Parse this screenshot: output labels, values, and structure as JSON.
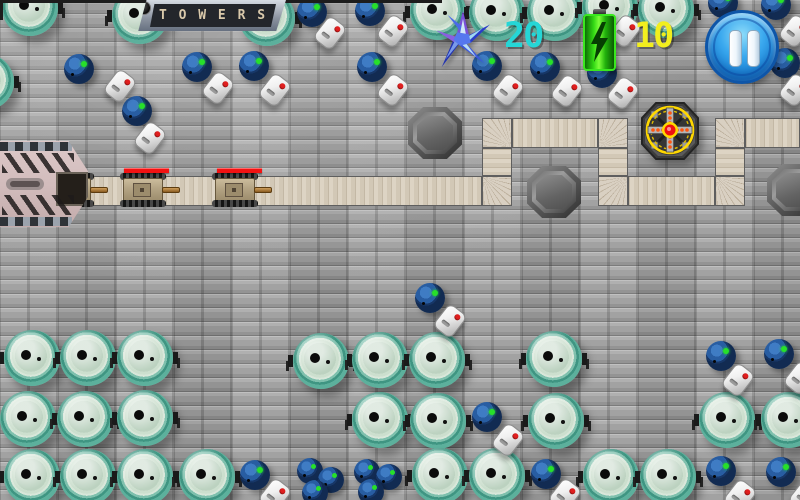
{
  "hud": {
    "sign_label": "T O W E R S",
    "stars_count": "20",
    "stars_color": "#25d6d6",
    "energy_count": "10",
    "energy_color": "#f2ee1e",
    "icons": [
      "shuriken-icon",
      "battery-icon",
      "pause-icon"
    ]
  },
  "scene": {
    "path": {
      "straights": [
        {
          "x": 75,
          "y": 176,
          "w": 407,
          "h": 30,
          "dir": "h"
        },
        {
          "x": 512,
          "y": 118,
          "w": 86,
          "h": 30,
          "dir": "h"
        },
        {
          "x": 628,
          "y": 176,
          "w": 87,
          "h": 30,
          "dir": "h"
        },
        {
          "x": 745,
          "y": 118,
          "w": 55,
          "h": 30,
          "dir": "h"
        },
        {
          "x": 482,
          "y": 148,
          "w": 30,
          "h": 28,
          "dir": "v"
        },
        {
          "x": 598,
          "y": 148,
          "w": 30,
          "h": 28,
          "dir": "v"
        },
        {
          "x": 715,
          "y": 148,
          "w": 30,
          "h": 28,
          "dir": "v"
        }
      ],
      "corners": [
        {
          "x": 482,
          "y": 176,
          "fx": 0,
          "fy": 0
        },
        {
          "x": 482,
          "y": 118,
          "fx": 1,
          "fy": 1
        },
        {
          "x": 598,
          "y": 118,
          "fx": 0,
          "fy": 1
        },
        {
          "x": 598,
          "y": 176,
          "fx": 1,
          "fy": 0
        },
        {
          "x": 715,
          "y": 176,
          "fx": 0,
          "fy": 0
        },
        {
          "x": 715,
          "y": 118,
          "fx": 1,
          "fy": 1
        }
      ]
    },
    "tower": {
      "type": "blade-tower",
      "x": 670,
      "y": 131
    },
    "tower_spots": [
      {
        "x": 435,
        "y": 133
      },
      {
        "x": 554,
        "y": 192
      },
      {
        "x": 794,
        "y": 190
      }
    ],
    "enemies": [
      {
        "type": "tank",
        "x": 74,
        "y": 190,
        "hp_x": 57,
        "hp_w": 23
      },
      {
        "type": "tank",
        "x": 146,
        "y": 190,
        "hp_x": 124,
        "hp_w": 45
      },
      {
        "type": "tank",
        "x": 238,
        "y": 190,
        "hp_x": 217,
        "hp_w": 45
      }
    ],
    "props": [
      {
        "type": "vat",
        "x": 30,
        "y": 8
      },
      {
        "type": "vat",
        "x": 140,
        "y": 16
      },
      {
        "type": "vat",
        "x": 267,
        "y": 18
      },
      {
        "type": "vat",
        "x": 438,
        "y": 12
      },
      {
        "type": "vat",
        "x": 497,
        "y": 13
      },
      {
        "type": "vat",
        "x": 555,
        "y": 13
      },
      {
        "type": "vat",
        "x": 610,
        "y": 8
      },
      {
        "type": "vat",
        "x": 666,
        "y": 10
      },
      {
        "type": "vat",
        "x": -14,
        "y": 82
      },
      {
        "type": "vat",
        "x": 32,
        "y": 358
      },
      {
        "type": "vat",
        "x": 88,
        "y": 358
      },
      {
        "type": "vat",
        "x": 145,
        "y": 358
      },
      {
        "type": "vat",
        "x": 321,
        "y": 361
      },
      {
        "type": "vat",
        "x": 380,
        "y": 360
      },
      {
        "type": "vat",
        "x": 437,
        "y": 360
      },
      {
        "type": "vat",
        "x": 554,
        "y": 359
      },
      {
        "type": "vat",
        "x": 28,
        "y": 419
      },
      {
        "type": "vat",
        "x": 85,
        "y": 419
      },
      {
        "type": "vat",
        "x": 145,
        "y": 418
      },
      {
        "type": "vat",
        "x": 380,
        "y": 420
      },
      {
        "type": "vat",
        "x": 438,
        "y": 421
      },
      {
        "type": "vat",
        "x": 556,
        "y": 421
      },
      {
        "type": "vat",
        "x": 727,
        "y": 420
      },
      {
        "type": "vat",
        "x": 789,
        "y": 420
      },
      {
        "type": "vat",
        "x": 32,
        "y": 477
      },
      {
        "type": "vat",
        "x": 88,
        "y": 477
      },
      {
        "type": "vat",
        "x": 145,
        "y": 477
      },
      {
        "type": "vat",
        "x": 207,
        "y": 477
      },
      {
        "type": "vat",
        "x": 440,
        "y": 476
      },
      {
        "type": "vat",
        "x": 497,
        "y": 476
      },
      {
        "type": "vat",
        "x": 611,
        "y": 477
      },
      {
        "type": "vat",
        "x": 668,
        "y": 477
      },
      {
        "type": "barrel",
        "x": 79,
        "y": 69
      },
      {
        "type": "barrel",
        "x": 137,
        "y": 111
      },
      {
        "type": "barrel",
        "x": 197,
        "y": 67
      },
      {
        "type": "barrel",
        "x": 254,
        "y": 66
      },
      {
        "type": "barrel",
        "x": 312,
        "y": 12
      },
      {
        "type": "barrel",
        "x": 370,
        "y": 11
      },
      {
        "type": "barrel",
        "x": 372,
        "y": 67
      },
      {
        "type": "barrel",
        "x": 487,
        "y": 66
      },
      {
        "type": "barrel",
        "x": 545,
        "y": 67
      },
      {
        "type": "barrel",
        "x": 602,
        "y": 73
      },
      {
        "type": "barrel",
        "x": 723,
        "y": 3
      },
      {
        "type": "barrel",
        "x": 776,
        "y": 5
      },
      {
        "type": "barrel",
        "x": 785,
        "y": 63
      },
      {
        "type": "barrel",
        "x": 430,
        "y": 298
      },
      {
        "type": "barrel",
        "x": 487,
        "y": 417
      },
      {
        "type": "barrel",
        "x": 255,
        "y": 475
      },
      {
        "type": "barrel",
        "x": 546,
        "y": 474
      },
      {
        "type": "barrel",
        "x": 721,
        "y": 471
      },
      {
        "type": "barrel",
        "x": 781,
        "y": 472
      },
      {
        "type": "barrel",
        "x": 721,
        "y": 356
      },
      {
        "type": "barrel",
        "x": 779,
        "y": 354
      },
      {
        "type": "barrel-small",
        "x": 310,
        "y": 471
      },
      {
        "type": "barrel-small",
        "x": 331,
        "y": 480
      },
      {
        "type": "barrel-small",
        "x": 315,
        "y": 493
      },
      {
        "type": "barrel-small",
        "x": 367,
        "y": 472
      },
      {
        "type": "barrel-small",
        "x": 389,
        "y": 477
      },
      {
        "type": "barrel-small",
        "x": 371,
        "y": 492
      },
      {
        "type": "canister",
        "x": 120,
        "y": 86
      },
      {
        "type": "canister",
        "x": 150,
        "y": 138
      },
      {
        "type": "canister",
        "x": 218,
        "y": 88
      },
      {
        "type": "canister",
        "x": 275,
        "y": 90
      },
      {
        "type": "canister",
        "x": 330,
        "y": 33
      },
      {
        "type": "canister",
        "x": 393,
        "y": 31
      },
      {
        "type": "canister",
        "x": 393,
        "y": 90
      },
      {
        "type": "canister",
        "x": 508,
        "y": 90
      },
      {
        "type": "canister",
        "x": 567,
        "y": 91
      },
      {
        "type": "canister",
        "x": 623,
        "y": 93
      },
      {
        "type": "canister",
        "x": 625,
        "y": 31
      },
      {
        "type": "canister",
        "x": 738,
        "y": 380
      },
      {
        "type": "canister",
        "x": 800,
        "y": 378
      },
      {
        "type": "canister",
        "x": 795,
        "y": 31
      },
      {
        "type": "canister",
        "x": 795,
        "y": 90
      },
      {
        "type": "canister",
        "x": 450,
        "y": 321
      },
      {
        "type": "canister",
        "x": 508,
        "y": 440
      },
      {
        "type": "canister",
        "x": 275,
        "y": 495
      },
      {
        "type": "canister",
        "x": 565,
        "y": 495
      },
      {
        "type": "canister",
        "x": 740,
        "y": 496
      },
      {
        "type": "canister",
        "x": 805,
        "y": 496
      }
    ]
  }
}
